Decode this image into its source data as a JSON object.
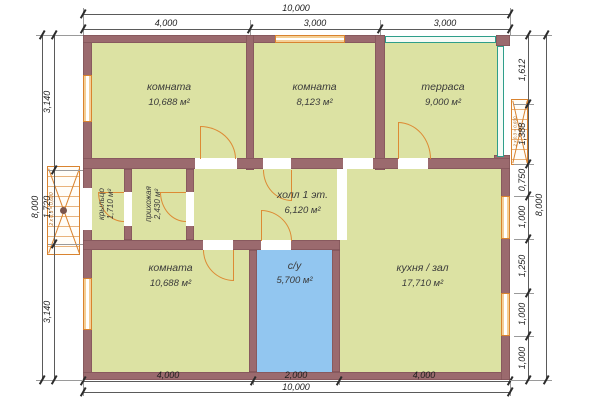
{
  "plan": {
    "rooms": {
      "room_top_left": {
        "label": "комната",
        "area": "10,688 м²"
      },
      "room_top_mid": {
        "label": "комната",
        "area": "8,123 м²"
      },
      "terrace": {
        "label": "терраса",
        "area": "9,000 м²"
      },
      "porch": {
        "label": "крыльцо",
        "area": "1,710 м²"
      },
      "entry": {
        "label": "прихожая",
        "area": "2,430 м²"
      },
      "hall": {
        "label": "холл 1 эт.",
        "area": "6,120 м²"
      },
      "room_bottom_left": {
        "label": "комната",
        "area": "10,688 м²"
      },
      "bathroom": {
        "label": "с/у",
        "area": "5,700 м²"
      },
      "kitchen": {
        "label": "кухня / зал",
        "area": "17,710 м²"
      }
    },
    "dimensions": {
      "top_total": "10,000",
      "top_segments": [
        "4,000",
        "3,000",
        "3,000"
      ],
      "bottom_segments": [
        "4,000",
        "2,000",
        "4,000"
      ],
      "bottom_total": "10,000",
      "left_total": "8,000",
      "left_segments": [
        "3,140",
        "1,720",
        "3,140"
      ],
      "right_total": "8,000",
      "right_segments": [
        "1,612",
        "1,388",
        "0,750",
        "1,000",
        "1,250",
        "1,000",
        "1,000"
      ]
    },
    "annotations": {
      "steps_note": "2 х 0,3 = 0,600"
    },
    "colors": {
      "wall": "#9b6a6e",
      "room_fill": "#dce2a3",
      "bathroom_fill": "#92c6f0",
      "accent_orange": "#dd8a34",
      "terrace_glazing": "#2f9e8a"
    }
  }
}
